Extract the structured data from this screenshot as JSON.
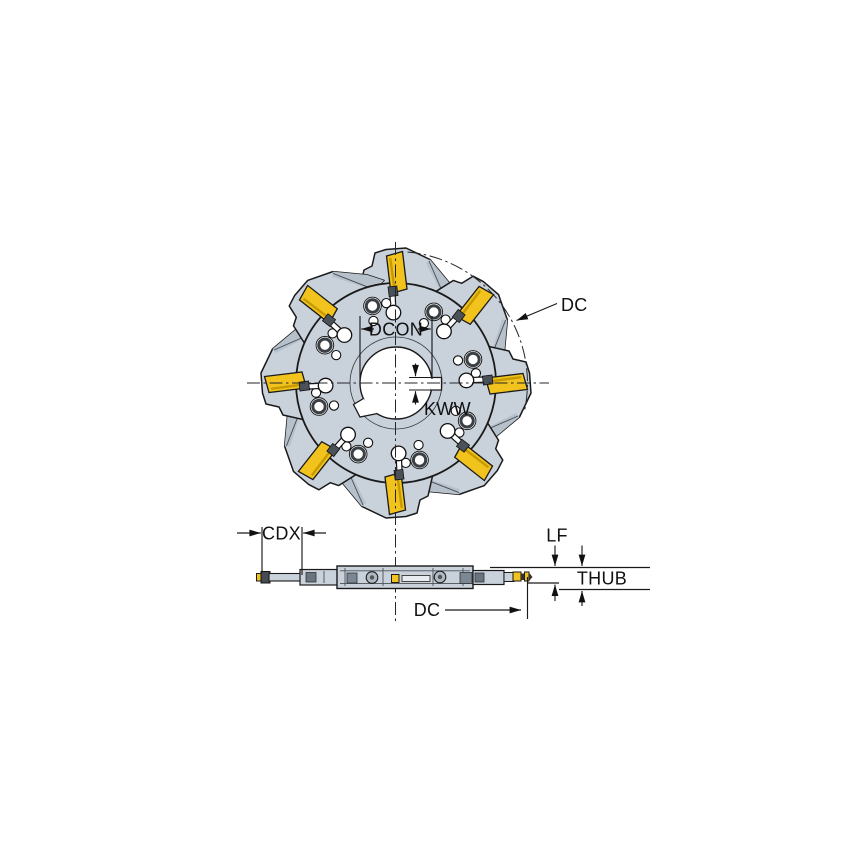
{
  "front_view": {
    "labels": {
      "dc": "DC",
      "dcon": "DCON",
      "kww": "KWW"
    }
  },
  "side_view": {
    "labels": {
      "cdx": "CDX",
      "lf": "LF",
      "thub": "THUB",
      "dc": "DC"
    }
  },
  "colors": {
    "body": "#c9d1db",
    "shade": "#b7c1cc",
    "insert": "#f2c31d",
    "insert_shade": "#c79a00",
    "line": "#1a1a1a",
    "bg": "#ffffff"
  }
}
